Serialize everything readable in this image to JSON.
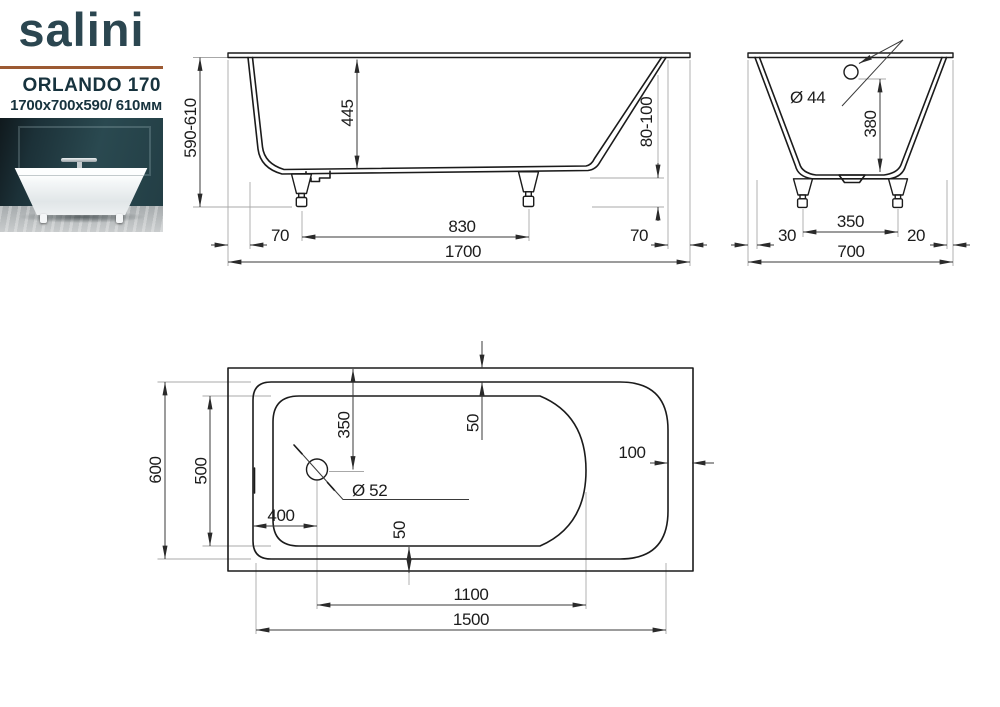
{
  "header": {
    "brand": "salini",
    "model": "ORLANDO 170",
    "size_line": "1700x700x590/ 610мм",
    "accent_color": "#9c5a33",
    "text_color": "#17333e"
  },
  "side_view": {
    "title": "side view",
    "height_total": "590-610",
    "inner_depth": "445",
    "feet_height": "80-100",
    "left_rim_offset": "70",
    "feet_spacing": "830",
    "right_rim_offset": "70",
    "length_total": "1700"
  },
  "end_view": {
    "title": "end view",
    "overflow_diameter": "Ø 44",
    "overflow_height": "380",
    "feet_spacing": "350",
    "left_rim_offset": "30",
    "right_rim_offset": "20",
    "width_total": "700"
  },
  "top_view": {
    "title": "bottom / plan view",
    "shell_width": "600",
    "basin_width": "500",
    "drain_to_end": "350",
    "rim_gap_top": "50",
    "rim_gap_right": "100",
    "drain_diameter": "Ø 52",
    "drain_from_left": "400",
    "rim_gap_bottom": "50",
    "basin_length": "1100",
    "shell_length": "1500"
  }
}
